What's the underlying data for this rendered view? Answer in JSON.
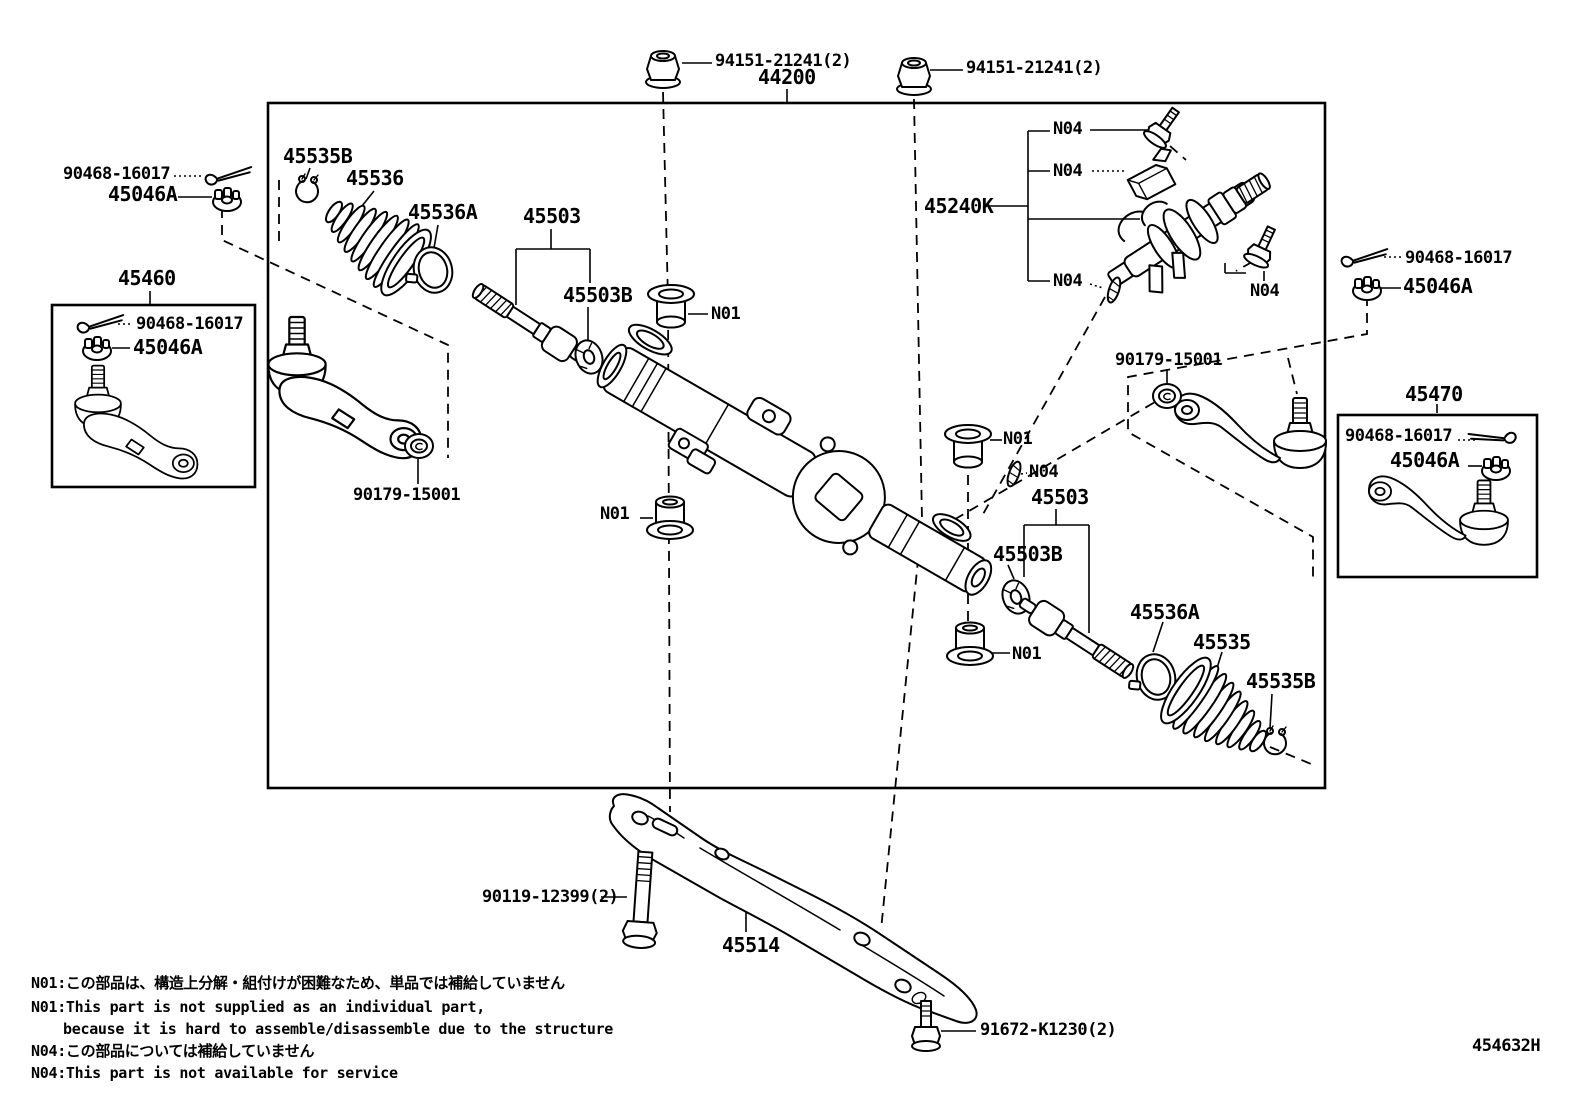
{
  "figure": {
    "code": "454632H"
  },
  "parts": {
    "assembly": "44200",
    "flange_nut": "94151-21241(2)",
    "cotter_pin": "90468-16017",
    "castle_nut": "45046A",
    "boot_clamp": "45535B",
    "boot_left": "45536",
    "boot_ring_clamp": "45536A",
    "inner_tie_rod": "45503",
    "claw_washer": "45503B",
    "tie_rod_left": "45460",
    "tie_rod_right": "45470",
    "lock_nut": "90179-15001",
    "valve_kit": "45240K",
    "boot_right": "45535",
    "crossmember": "45514",
    "bolt_long": "90119-12399(2)",
    "bolt_short": "91672-K1230(2)",
    "note_n01": "N01",
    "note_n04": "N04"
  },
  "legend": {
    "n01_jp": "N01:この部品は、構造上分解・組付けが困難なため、単品では補給していません",
    "n01_en_1": "N01:This part is not supplied as an individual part,",
    "n01_en_2": "because it is hard to assemble/disassemble due to the structure",
    "n04_jp": "N04:この部品については補給していません",
    "n04_en": "N04:This part is not available for service"
  }
}
